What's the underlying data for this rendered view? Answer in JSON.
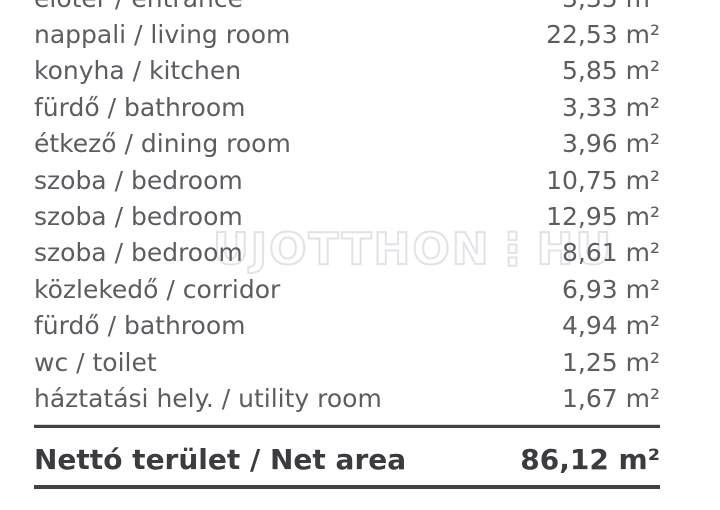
{
  "watermark": "UJOTTHON⋮HU",
  "table": {
    "rows": [
      {
        "label": "előtér / entrance",
        "value": "3,35 m²"
      },
      {
        "label": "nappali / living room",
        "value": "22,53 m²"
      },
      {
        "label": "konyha / kitchen",
        "value": "5,85 m²"
      },
      {
        "label": "fürdő / bathroom",
        "value": "3,33 m²"
      },
      {
        "label": "étkező / dining room",
        "value": "3,96 m²"
      },
      {
        "label": "szoba / bedroom",
        "value": "10,75 m²"
      },
      {
        "label": "szoba / bedroom",
        "value": "12,95 m²"
      },
      {
        "label": "szoba / bedroom",
        "value": "8,61 m²"
      },
      {
        "label": "közlekedő / corridor",
        "value": "6,93 m²"
      },
      {
        "label": "fürdő / bathroom",
        "value": "4,94 m²"
      },
      {
        "label": "wc / toilet",
        "value": "1,25 m²"
      },
      {
        "label": "háztatási hely. / utility room",
        "value": "1,67 m²"
      }
    ],
    "total": {
      "label": "Nettó terület / Net area",
      "value": "86,12 m²"
    }
  },
  "colors": {
    "row_text": "#5b5d61",
    "total_text": "#3b3c3f",
    "rule": "#414245",
    "watermark_outline": "#e2e2e7",
    "background": "#ffffff"
  }
}
